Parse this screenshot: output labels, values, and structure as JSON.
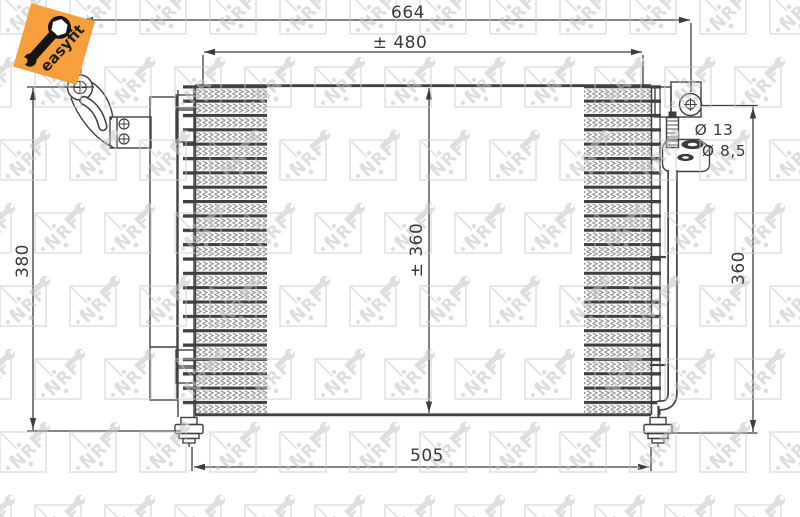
{
  "meta": {
    "type": "technical-drawing",
    "subject": "air-conditioning condenser"
  },
  "brand": "NRF",
  "badge": {
    "label": "easyfit"
  },
  "dimensions": {
    "overall_width": "664",
    "core_width": "± 480",
    "core_height": "± 360",
    "height_left": "380",
    "height_right": "360",
    "connector_span": "505",
    "port_large": "Ø 13",
    "port_small": "Ø 8,5"
  },
  "colors": {
    "line": "#3e3e3e",
    "fin": "#8d8d8d",
    "watermark": "#cccccc",
    "badge": "#F5A03C"
  }
}
